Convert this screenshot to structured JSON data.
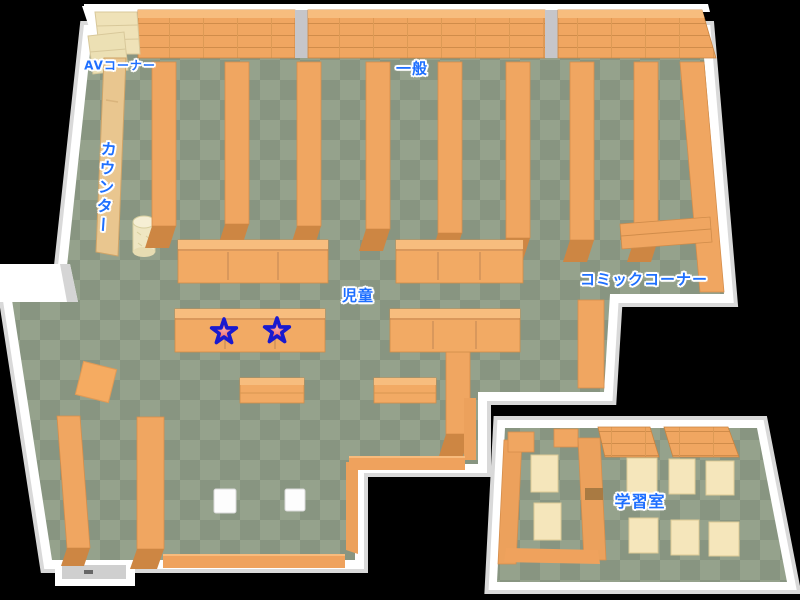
{
  "labels": {
    "av_corner": "AVコーナー",
    "general": "一般",
    "counter": "カウンター",
    "comic_corner": "コミックコーナー",
    "children": "児童",
    "study_room": "学習室"
  },
  "markers": {
    "stars": [
      "star",
      "star"
    ]
  },
  "colors": {
    "floor_light": "#95a28c",
    "floor_dark": "#889581",
    "wall": "#ffffff",
    "wall_shade": "#d9d9d9",
    "shelf_orange": "#f0a661",
    "shelf_edge": "#cd8643",
    "counter_tan": "#e9c68f",
    "table_cream": "#f5e6bb",
    "label_blue": "#1e6fff",
    "star_fill": "#e85050",
    "star_outline": "#1a1ace",
    "background": "#000000"
  }
}
